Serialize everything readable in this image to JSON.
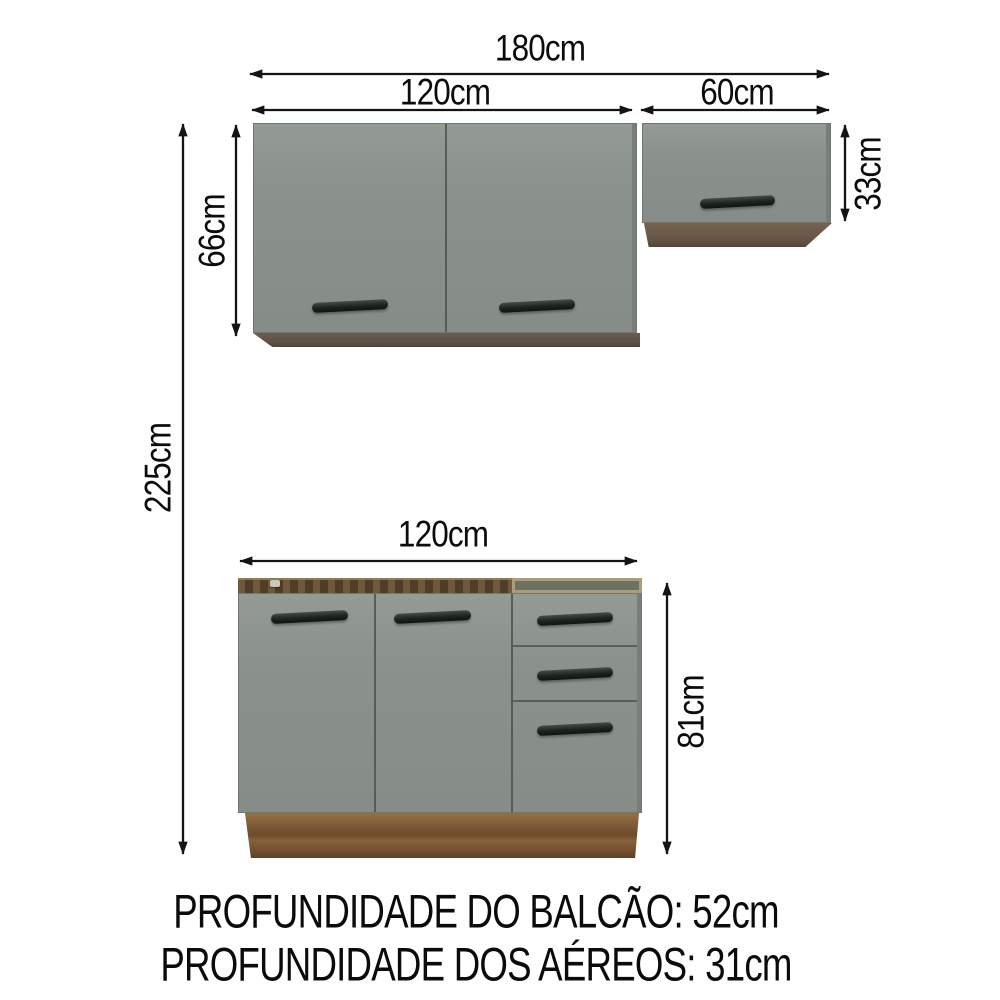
{
  "diagram": {
    "dims": {
      "total_width": "180cm",
      "upper_left_width": "120cm",
      "upper_right_width": "60cm",
      "upper_left_height": "66cm",
      "upper_right_height": "33cm",
      "total_height": "225cm",
      "base_width": "120cm",
      "base_height": "81cm"
    },
    "footer": {
      "line1": "PROFUNDIDADE DO BALCÃO: 52cm",
      "line2": "PROFUNDIDADE DOS AÉREOS: 31cm"
    },
    "colors": {
      "background": "#ffffff",
      "arrow-black": "#141414",
      "cabinet-gray": "#8b918c",
      "cabinet-gray-dark": "#787e79",
      "seam": "#4d524e",
      "handle-dark": "#1d231e",
      "wood-underside": "#5f5248",
      "wood-underside-2": "#6a594a",
      "rim-wood": "#5b452c",
      "rim-wood-light": "#8f7b52",
      "open-frame-tan": "#ab9d77",
      "open-interior": "#6d7164",
      "base-wood": "#7d5835",
      "base-wood-light": "#8f6b42"
    }
  }
}
